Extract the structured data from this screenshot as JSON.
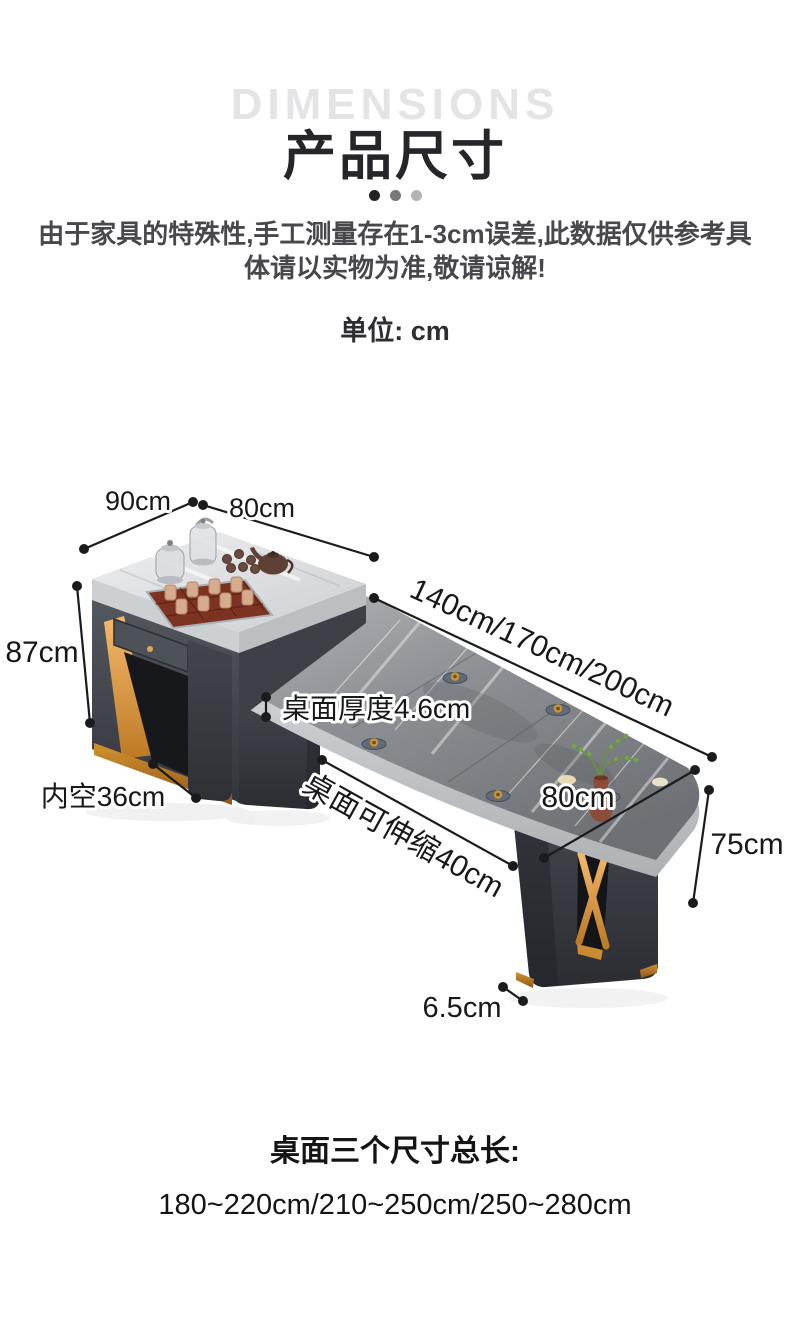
{
  "header": {
    "watermark": "DIMENSIONS",
    "title": "产品尺寸",
    "disclaimer_line1": "由于家具的特殊性,手工测量存在1-3cm误差,此数据仅供参考具",
    "disclaimer_line2": "体请以实物为准,敬请谅解!",
    "unit_label": "单位: cm"
  },
  "diagram": {
    "cabinet_depth": "90cm",
    "cabinet_width": "80cm",
    "cabinet_height": "87cm",
    "inner_clearance": "内空36cm",
    "table_lengths": "140cm/170cm/200cm",
    "top_thickness": "桌面厚度4.6cm",
    "extendable_range": "桌面可伸缩40cm",
    "table_depth": "80cm",
    "table_height": "75cm",
    "foot_height": "6.5cm"
  },
  "footer": {
    "total_length_label": "桌面三个尺寸总长:",
    "total_length_value": "180~220cm/210~250cm/250~280cm"
  },
  "colors": {
    "dimension_line": "#1a1b1d",
    "accent_gold": "#d99a4e",
    "marble_light": "#dfe1e3",
    "marble_dark": "#83868a",
    "cabinet_body": "#42464d",
    "watermark_gray": "#e4e4e6"
  }
}
